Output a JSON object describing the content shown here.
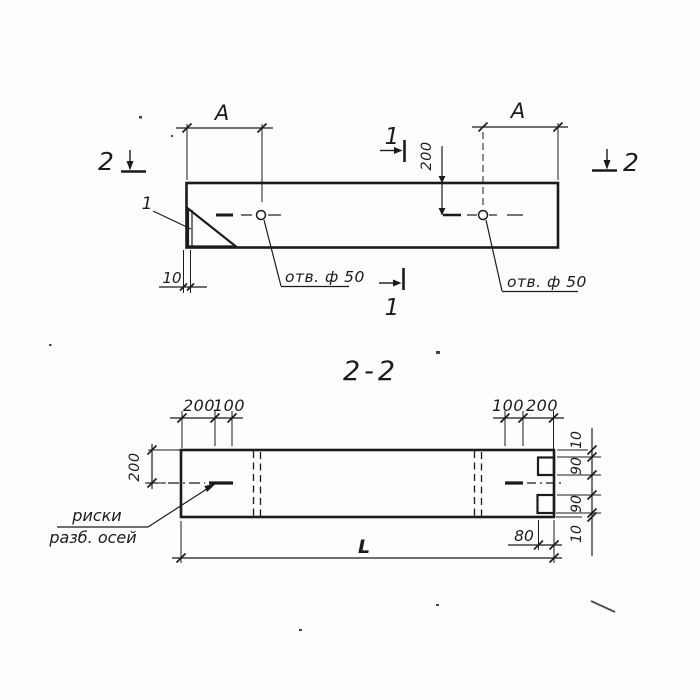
{
  "title": "2-2",
  "colors": {
    "ink": "#1b1b1b",
    "paper": "#ffffff"
  },
  "plan_view": {
    "dim_a_left": "A",
    "dim_a_right": "A",
    "dim_hole_offset": "200",
    "dim_plate_thickness": "10",
    "hole_label_left": "отв. ф 50",
    "hole_label_right": "отв. ф 50",
    "detail_mark": "1",
    "section_mark_1_top": "1",
    "section_mark_1_bottom": "1",
    "section_mark_2_left": "2",
    "section_mark_2_right": "2"
  },
  "section_view": {
    "dims_top_left": [
      "200",
      "100"
    ],
    "dims_top_right": [
      "100",
      "200"
    ],
    "dim_height": "200",
    "dims_right_chain": [
      "10",
      "90",
      "90",
      "10"
    ],
    "dim_recess": "80",
    "dim_length": "L",
    "axis_note_line1": "риски",
    "axis_note_line2": "разб. осей"
  }
}
